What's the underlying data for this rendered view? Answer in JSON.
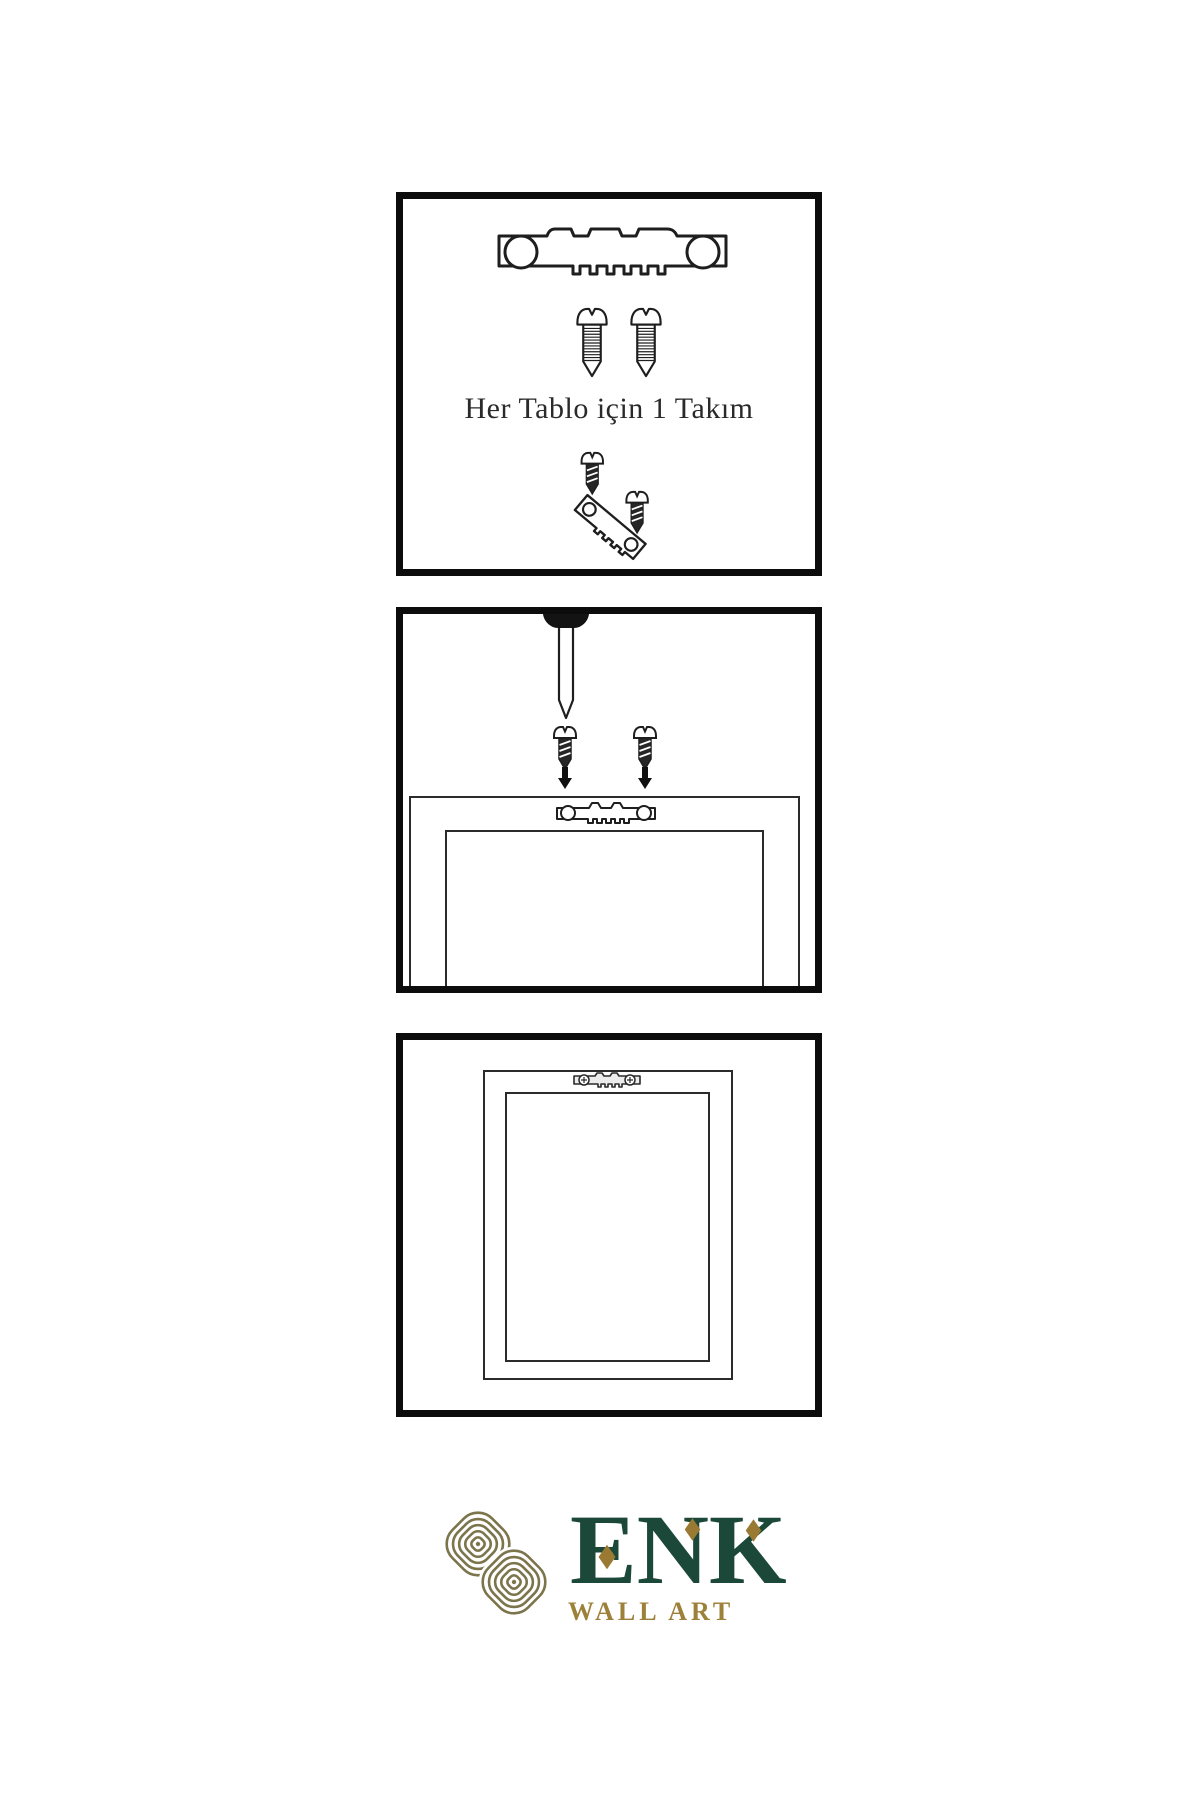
{
  "colors": {
    "line": "#1e1e1e",
    "panel_border": "#0c0c0c",
    "dark_screw_fill": "#262626",
    "logo_green": "#1b4839",
    "logo_gold": "#9a7a33",
    "knot_olive": "#7c744b",
    "tagline_gold": "#9d8139"
  },
  "panel1": {
    "caption": "Her Tablo için 1 Takım",
    "icons": [
      "sawtooth-hanger-icon",
      "screw-icon",
      "screw-icon",
      "angled-screw-into-hanger-icon"
    ]
  },
  "panel2": {
    "icons": [
      "nail-icon",
      "dark-screw-icon",
      "dark-screw-icon",
      "arrow-down-icon",
      "arrow-down-icon",
      "sawtooth-hanger-icon",
      "frame-back-icon"
    ]
  },
  "panel3": {
    "icons": [
      "mounted-sawtooth-hanger-icon",
      "hanging-frame-icon"
    ]
  },
  "logo": {
    "brand": "ENK",
    "tagline": "WALL ART",
    "mark": "knot-icon"
  }
}
